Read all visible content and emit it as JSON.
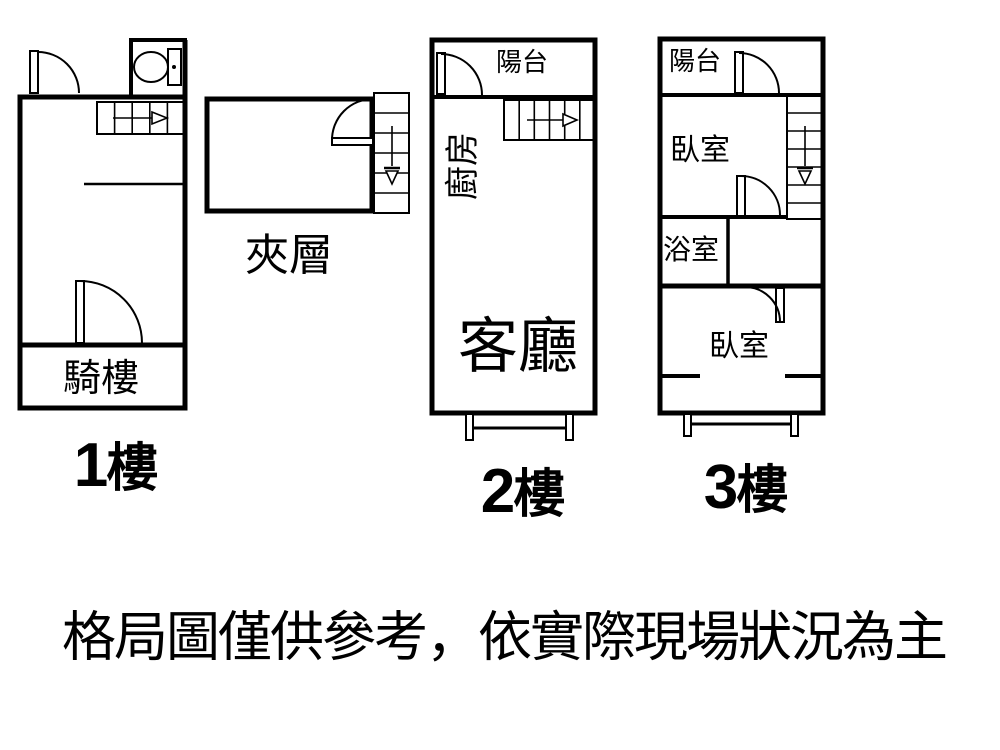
{
  "floors": {
    "f1": {
      "number": "1",
      "suffix": "樓",
      "rooms": {
        "arcade": "騎樓"
      }
    },
    "mezzanine": {
      "label": "夾層"
    },
    "f2": {
      "number": "2",
      "suffix": "樓",
      "rooms": {
        "balcony": "陽台",
        "kitchen": "廚房",
        "living_room": "客廳"
      }
    },
    "f3": {
      "number": "3",
      "suffix": "樓",
      "rooms": {
        "balcony": "陽台",
        "bedroom_upper": "臥室",
        "bathroom": "浴室",
        "bedroom_lower": "臥室"
      }
    }
  },
  "disclaimer": "格局圖僅供參考，依實際現場狀況為主",
  "icons": {
    "toilet": "toilet-icon",
    "stairs_arrow_right": "arrow-right-icon",
    "stairs_arrow_down": "arrow-down-icon",
    "door_swing": "door-swing-icon"
  },
  "colors": {
    "line": "#000000",
    "background": "#ffffff"
  }
}
